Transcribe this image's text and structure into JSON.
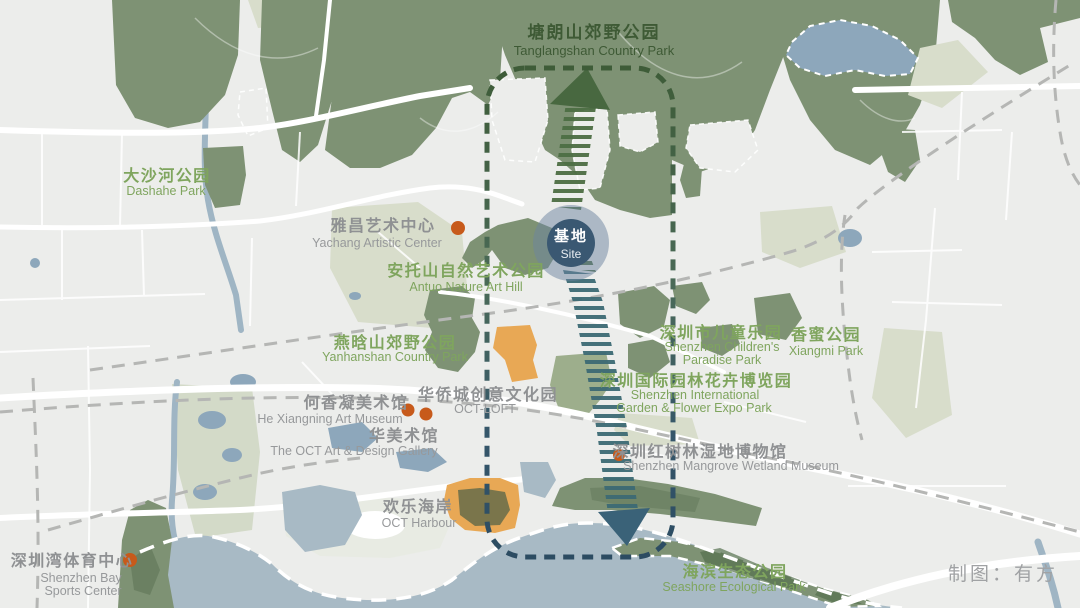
{
  "credit": {
    "text": "制图：有方"
  },
  "site_marker": {
    "zh": "基地",
    "en": "Site"
  },
  "labels": {
    "tanglangshan": {
      "zh": "塘朗山郊野公园",
      "en1": "Tanglangshan Country Park"
    },
    "dashahe": {
      "zh": "大沙河公园",
      "en1": "Dashahe Park"
    },
    "yachang": {
      "zh": "雅昌艺术中心",
      "en1": "Yachang Artistic Center"
    },
    "antuo": {
      "zh": "安托山自然艺术公园",
      "en1": "Antuo Nature Art Hill"
    },
    "yanhanshan": {
      "zh": "燕晗山郊野公园",
      "en1": "Yanhanshan Country Park"
    },
    "children": {
      "zh": "深圳市儿童乐园",
      "en1": "Shenzhen Children's",
      "en2": "Paradise Park"
    },
    "xiangmi": {
      "zh": "香蜜公园",
      "en1": "Xiangmi Park"
    },
    "expo": {
      "zh": "深圳国际园林花卉博览园",
      "en1": "Shenzhen International",
      "en2": "Garden & Flower Expo Park"
    },
    "hexiangning": {
      "zh": "何香凝美术馆",
      "en1": "He Xiangning Art Museum"
    },
    "octloft": {
      "zh": "华侨城创意文化园",
      "en1": "OCT-LOFT"
    },
    "huamuseum": {
      "zh": "华美术馆",
      "en1": "The OCT Art & Design Gallery"
    },
    "mangrove": {
      "zh": "深圳红树林湿地博物馆",
      "en1": "Shenzhen Mangrove Wetland Museum"
    },
    "octharbour": {
      "zh": "欢乐海岸",
      "en1": "OCT Harbour"
    },
    "sportscenter": {
      "zh": "深圳湾体育中心",
      "en1": "Shenzhen Bay",
      "en2": "Sports Center"
    },
    "seashore": {
      "zh": "海滨生态公园",
      "en1": "Seashore Ecological Park"
    }
  },
  "colors": {
    "land": "#ECEDEB",
    "park_green": "#7E9274",
    "pale_green": "#D8DDCB",
    "park_label_green": "#7FA55E",
    "park_label_dark": "#3E5A35",
    "venue_label_gray": "#8F9193",
    "marker_orange": "#C75A1B",
    "highlight_orange": "#E8A855",
    "water_blue": "#A8BAC5",
    "lake_blue": "#8DA7BB",
    "site_circle": "#3A5872",
    "corridor_green": "#4D6E44",
    "corridor_teal": "#3C6A74",
    "boundary_top": "#3E5C38",
    "boundary_bottom": "#2C4C62"
  }
}
